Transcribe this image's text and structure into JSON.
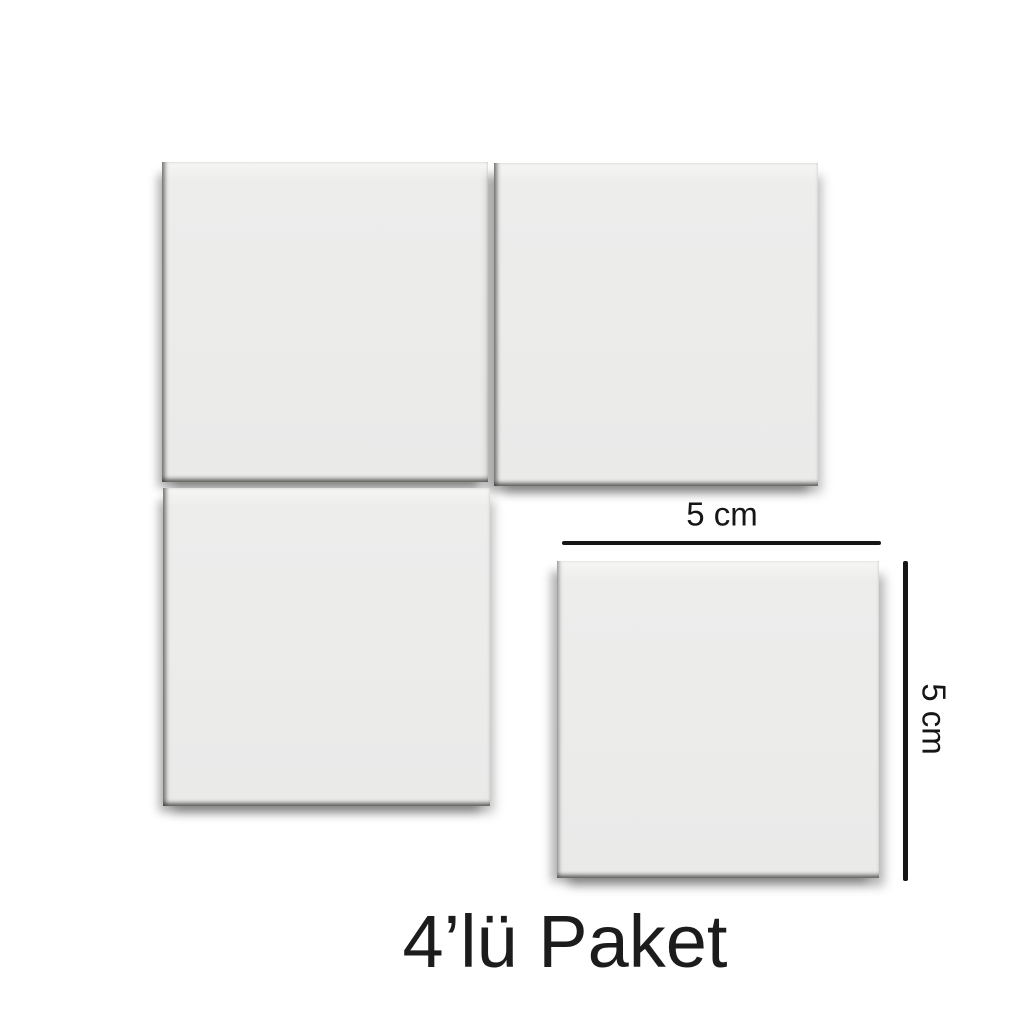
{
  "image": {
    "caption": "4’lü Paket",
    "pack_count": 4
  },
  "dimension_annotations": {
    "width_label": "5 cm",
    "height_label": "5 cm"
  },
  "squares": [
    {
      "position": "top-left"
    },
    {
      "position": "top-right"
    },
    {
      "position": "bottom-left"
    },
    {
      "position": "bottom-right"
    }
  ],
  "colors": {
    "background": "#ffffff",
    "square_fill": "#ededec",
    "square_fill_light": "#f6f6f5",
    "annotation": "#161616",
    "caption_text": "#1c1c1c"
  }
}
